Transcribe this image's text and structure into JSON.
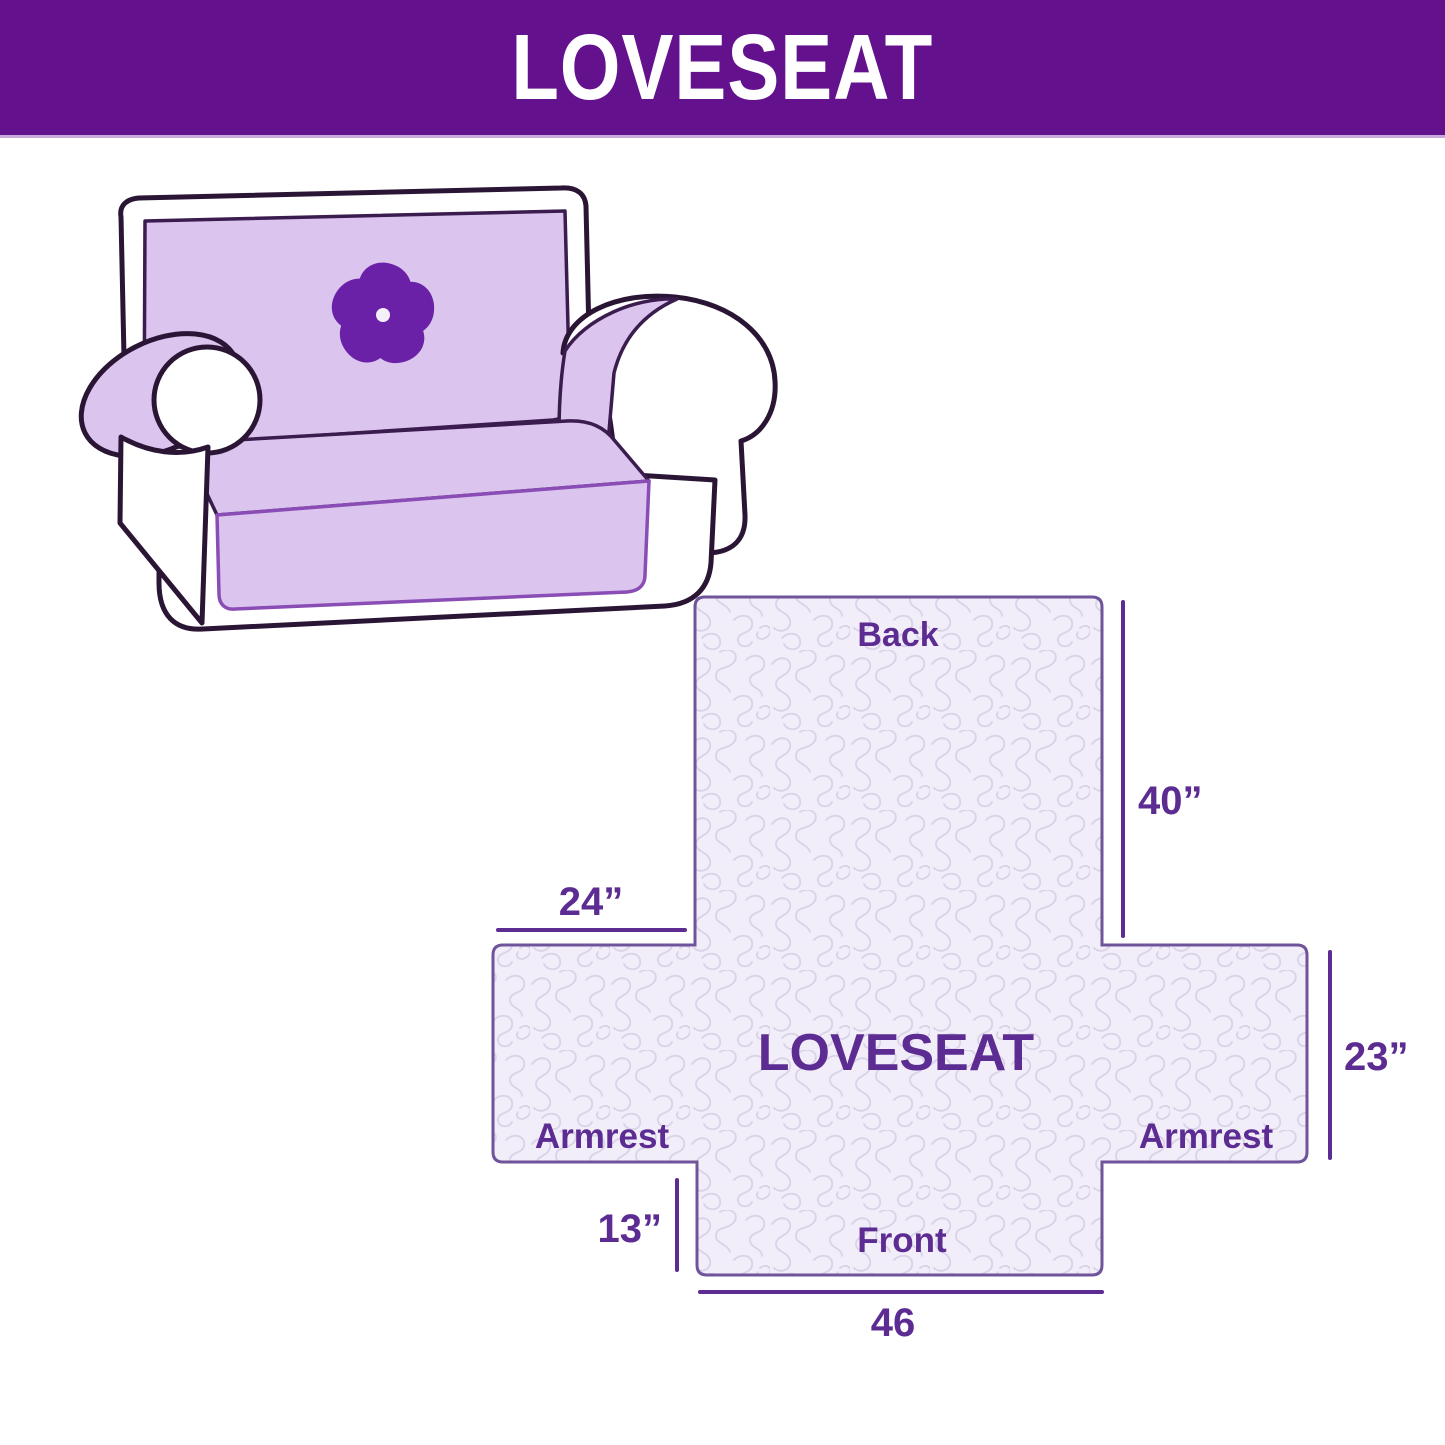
{
  "header": {
    "title": "LOVESEAT"
  },
  "illustration": {
    "description": "loveseat sofa with slipcover",
    "logo_icon": "pinwheel-icon"
  },
  "diagram": {
    "labels": {
      "back": "Back",
      "center": "LOVESEAT",
      "armrest_left": "Armrest",
      "armrest_right": "Armrest",
      "front": "Front"
    },
    "dimensions": {
      "back_height": "40”",
      "armrest_top": "24”",
      "side_height": "23”",
      "front_drop": "13”",
      "front_width": "46"
    }
  },
  "colors": {
    "header_bg": "#64118E",
    "header_strip": "#C9A8DC",
    "header_text": "#FFFFFF",
    "accent": "#5C2C92",
    "cover_fill": "#F1EDF9",
    "cover_border": "#6F549B",
    "pattern_line": "#D9D2E8",
    "sofa_cover": "#DBC5EE",
    "sofa_outline": "#2B1535",
    "sofa_cover_edge": "#8A4DB5",
    "sofa_cover_line": "#3A1C4E",
    "logo": "#6A21A8"
  }
}
